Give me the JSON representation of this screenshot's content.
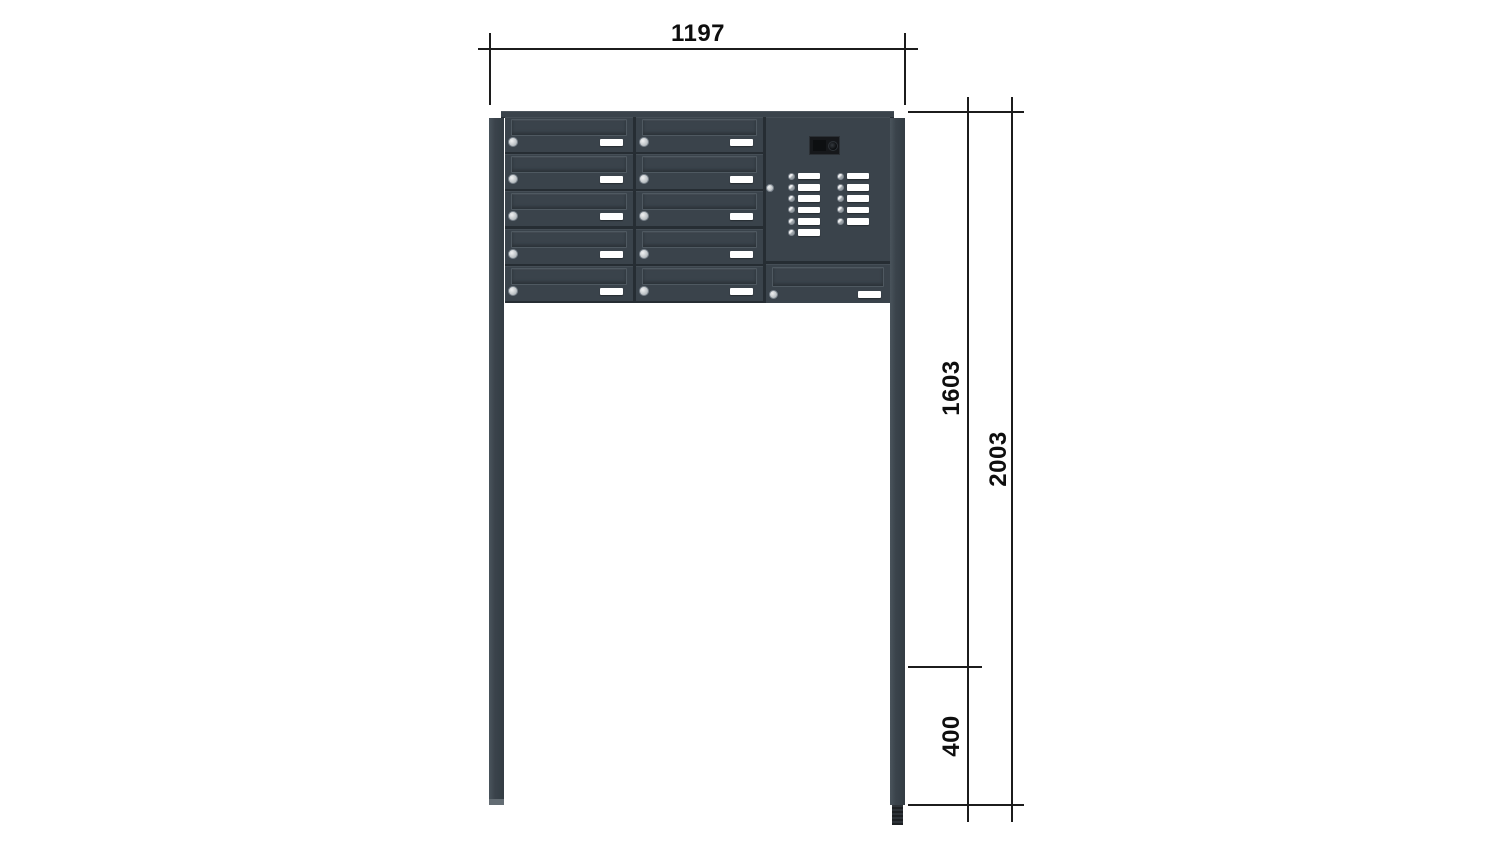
{
  "diagram": {
    "dimension_labels": {
      "width": "1197",
      "height_top_to_ground": "1603",
      "height_total": "2003",
      "anchor_depth": "400"
    },
    "unit": {
      "mailbox_columns": 2,
      "mailbox_rows_per_column": 5,
      "bottom_right_mailboxes": 1,
      "intercom": {
        "left_button_count": 6,
        "right_button_count": 5,
        "has_camera": true,
        "has_lock": true
      }
    },
    "colors": {
      "line": "#1c1c1c",
      "body": "#3a434b",
      "body_dark": "#262d33",
      "highlight": "#454e56",
      "flap_border": "#4f5961",
      "plate": "#ffffff",
      "metal_light": "#f0f1f2",
      "metal_dark": "#9aa1a6",
      "camera_body": "#16181b",
      "anchor": "#1d2023",
      "post_light": "#4a545c",
      "post_dark": "#333c43"
    }
  }
}
